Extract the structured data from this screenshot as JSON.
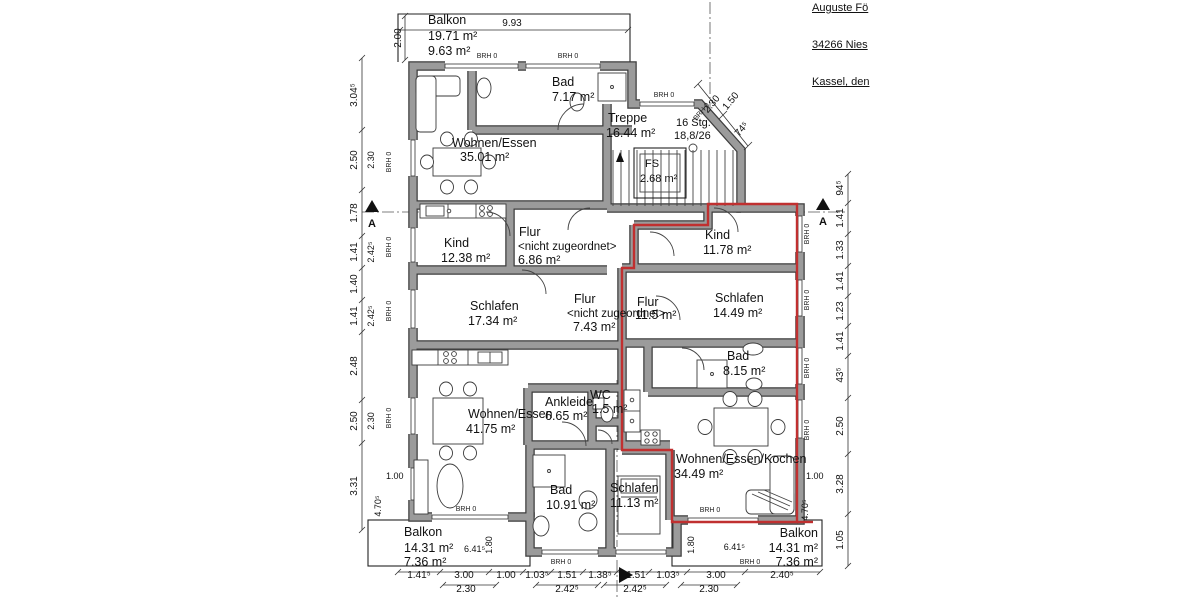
{
  "header": {
    "line1": "Auguste Fö",
    "line2": "34266 Nies",
    "line3": "Kassel, den"
  },
  "rooms": {
    "balkon_top": {
      "name": "Balkon",
      "area": "19.71 m²",
      "area2": "9.63 m²"
    },
    "wohnen_top": {
      "name": "Wohnen/Essen",
      "area": "35.01 m²"
    },
    "bad_top": {
      "name": "Bad",
      "area": "7.17 m²"
    },
    "treppe": {
      "name": "Treppe",
      "area": "16.44 m²"
    },
    "stg": {
      "line1": "16 Stg.",
      "line2": "18,8/26"
    },
    "fs": {
      "name": "FS",
      "area": "2.68 m²"
    },
    "kind_left": {
      "name": "Kind",
      "area": "12.38 m²"
    },
    "flur_left": {
      "name": "Flur",
      "tag": "<nicht zugeordnet>",
      "area": "6.86 m²"
    },
    "schlafen_left": {
      "name": "Schlafen",
      "area": "17.34 m²"
    },
    "kind_right": {
      "name": "Kind",
      "area": "11.78 m²"
    },
    "schlafen_right": {
      "name": "Schlafen",
      "area": "14.49 m²"
    },
    "flur_mid": {
      "name": "Flur",
      "tag": "<nicht zugeordnet>",
      "area": "7.43 m²"
    },
    "flur_right": {
      "name": "Flur",
      "area": "11.5 m²"
    },
    "bad_right": {
      "name": "Bad",
      "area": "8.15 m²"
    },
    "wohnen_bottom": {
      "name": "Wohnen/Essen",
      "area": "41.75 m²"
    },
    "ankleide": {
      "name": "Ankleide",
      "area": "6.65 m²"
    },
    "wc": {
      "name": "WC",
      "area": "1.5 m²"
    },
    "bad_bottom": {
      "name": "Bad",
      "area": "10.91 m²"
    },
    "schlafen_bottom": {
      "name": "Schlafen",
      "area": "11.13 m²"
    },
    "wek": {
      "name": "Wohnen/Essen/Kochen",
      "area": "34.49 m²"
    },
    "balkon_bl": {
      "name": "Balkon",
      "area": "14.31 m²",
      "area2": "7.36 m²"
    },
    "balkon_br": {
      "name": "Balkon",
      "area": "14.31 m²",
      "area2": "7.36 m²"
    }
  },
  "dims": {
    "top_width": "9.93",
    "top_depth": "2.00",
    "left_outer": [
      "3.04⁵",
      "2.50",
      "1.78",
      "1.41",
      "1.40",
      "1.41",
      "2.48",
      "2.50",
      "3.31"
    ],
    "left_inner": [
      "2.30",
      "2.42⁵",
      "2.42⁵",
      "2.30"
    ],
    "right_outer": [
      "94⁵",
      "1.41",
      "1.33",
      "1.41",
      "1.23",
      "1.41",
      "43⁵",
      "2.50",
      "3.28",
      "1.05"
    ],
    "bottom_row1": [
      "1.41⁵",
      "3.00",
      "1.00",
      "1.03⁵",
      "1.51",
      "1.38⁵",
      "1.51",
      "1.03⁵",
      "3.00",
      "2.40⁵"
    ],
    "bottom_row2": [
      "2.30",
      "2.42⁵",
      "2.42⁵",
      "2.30"
    ],
    "stair_diag": {
      "a": "1.50",
      "b": "2.30",
      "c": "74⁵"
    },
    "balcony_left": {
      "width": "6.41⁵",
      "depth_inner": "1.80",
      "side": "1.00",
      "depth": "4.70⁵"
    },
    "balcony_right": {
      "width": "6.41⁵",
      "depth_inner": "1.80",
      "side": "1.00",
      "depth": "4.70⁵"
    }
  },
  "labels": {
    "brh": "BRH 0",
    "section": "A"
  }
}
